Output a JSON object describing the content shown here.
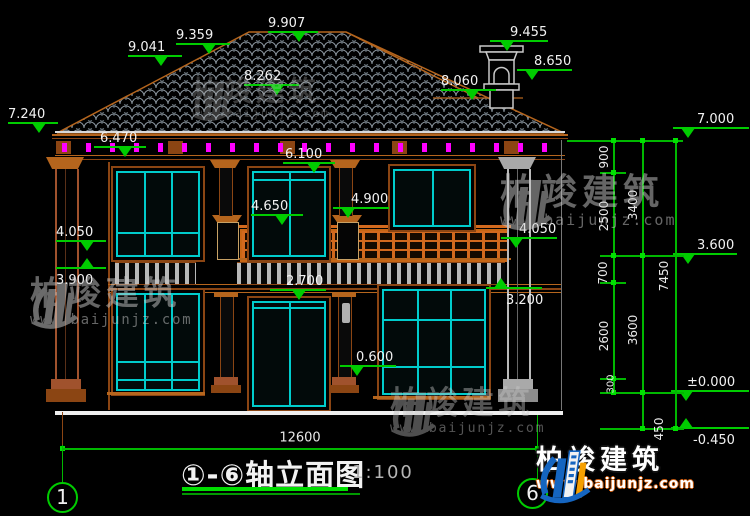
{
  "drawing": {
    "title": "①-⑥轴立面图",
    "scale": "1:100",
    "axis_start": "1",
    "axis_end": "6"
  },
  "levels": [
    "9.907",
    "9.359",
    "9.041",
    "9.455",
    "8.650",
    "8.262",
    "8.060",
    "7.240",
    "7.000",
    "6.470",
    "6.100",
    "4.900",
    "4.650",
    "4.050",
    "3.900",
    "4.050",
    "3.600",
    "3.200",
    "2.700",
    "0.600",
    "±0.000",
    "-0.450"
  ],
  "dims": {
    "right_inner": [
      "900",
      "2500",
      "700",
      "2600",
      "300"
    ],
    "right_mid": [
      "3400",
      "3600",
      "450"
    ],
    "right_overall": "7450",
    "bottom_overall": "12600"
  },
  "watermark": {
    "name": "柏竣建筑",
    "url": "www.baijunjz.com"
  },
  "logo": {
    "name": "柏竣建筑",
    "url": "www.baijunjz.com"
  },
  "colors": {
    "dimension_green": "#00cc00",
    "text_white": "#f2f2f2",
    "window_cyan": "#00cccc",
    "trim_orange": "#b5651d",
    "accent_magenta": "#ff00ff",
    "tile_gray": "#8f9aa3",
    "logo_blue": "#1565c0",
    "logo_orange": "#f59f00"
  }
}
